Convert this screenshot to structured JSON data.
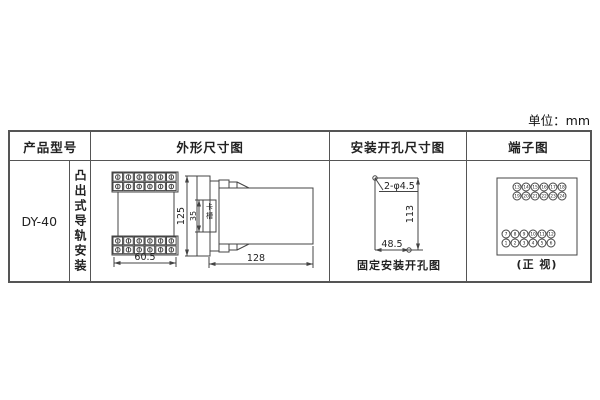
{
  "page": {
    "unit_label": "单位：mm"
  },
  "table": {
    "headers": {
      "product_model": "产品型号",
      "outline": "外形尺寸图",
      "install": "安装开孔尺寸图",
      "terminal": "端子图"
    },
    "product": {
      "model": "DY-40",
      "mounting": "凸出式导轨安装"
    }
  },
  "outline_drawing": {
    "width": "60.5",
    "height": "125",
    "slot_height": "35",
    "slot_label": "卡槽",
    "depth": "128"
  },
  "install_drawing": {
    "holes": "2-φ4.5",
    "height": "113",
    "width": "48.5",
    "caption": "固定安装开孔图"
  },
  "terminal_diagram": {
    "caption": "(正 视)",
    "top_group": [
      [
        "13",
        "14",
        "15",
        "16",
        "17",
        "18"
      ],
      [
        "19",
        "20",
        "21",
        "22",
        "23",
        "24"
      ]
    ],
    "bottom_group": [
      [
        "7",
        "8",
        "9",
        "10",
        "11",
        "12"
      ],
      [
        "1",
        "2",
        "3",
        "4",
        "5",
        "6"
      ]
    ]
  },
  "colors": {
    "line": "#444",
    "text": "#222",
    "border": "#555"
  }
}
